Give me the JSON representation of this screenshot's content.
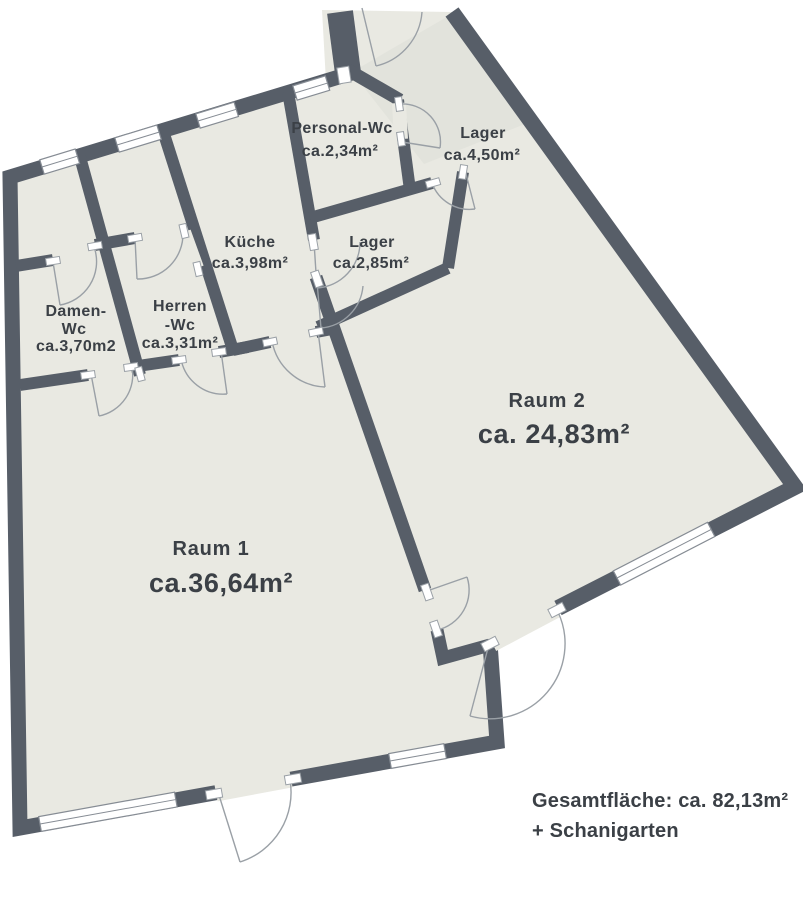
{
  "plan": {
    "rooms": {
      "personal_wc": {
        "name": "Personal-Wc",
        "area": "ca.2,34m²"
      },
      "lager_klein": {
        "name": "Lager",
        "area": "ca.4,50m²"
      },
      "kueche": {
        "name": "Küche",
        "area": "ca.3,98m²"
      },
      "lager_mittel": {
        "name": "Lager",
        "area": "ca.2,85m²"
      },
      "damen_wc": {
        "line1": "Damen-",
        "line2": "Wc",
        "area": "ca.3,70m2"
      },
      "herren_wc": {
        "line1": "Herren",
        "line2": "-Wc",
        "area": "ca.3,31m²"
      },
      "raum2": {
        "name": "Raum 2",
        "area": "ca. 24,83m²"
      },
      "raum1": {
        "name": "Raum 1",
        "area": "ca.36,64m²"
      }
    },
    "footer": {
      "line1": "Gesamtfläche: ca. 82,13m²",
      "line2": "+ Schanigarten"
    },
    "colors": {
      "wall": "#575e68",
      "floor": "#e9e9e2",
      "text": "#3b4046",
      "door_arc": "#9aa0a6",
      "window_frame": "#868c94"
    }
  }
}
